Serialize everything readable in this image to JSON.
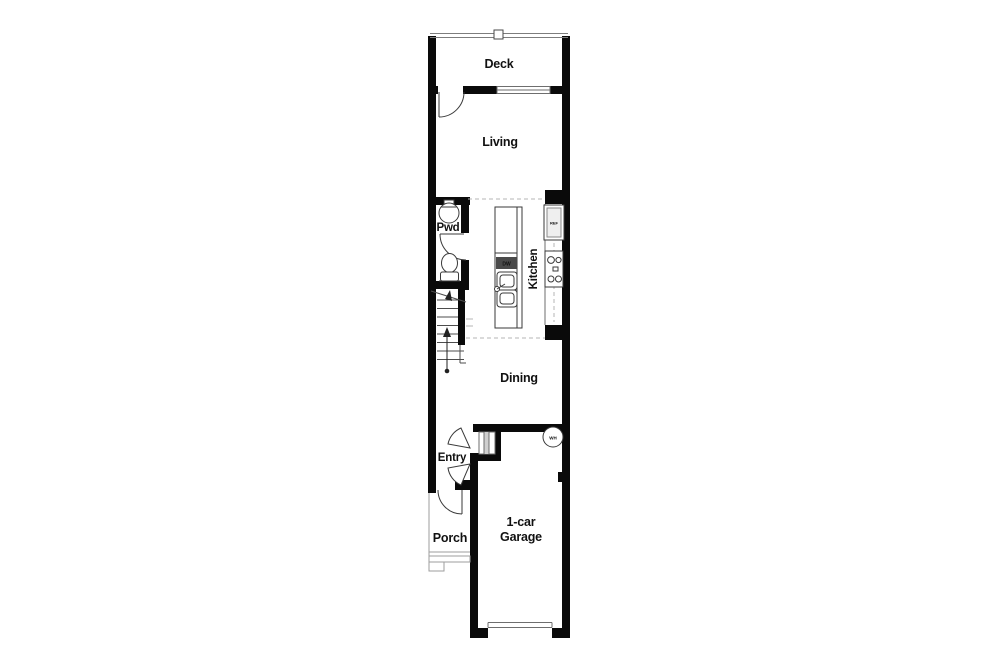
{
  "floor_plan": {
    "labels": {
      "deck": "Deck",
      "living": "Living",
      "pwd": "Pwd",
      "kitchen": "Kitchen",
      "dining": "Dining",
      "entry": "Entry",
      "porch": "Porch",
      "garage_line1": "1-car",
      "garage_line2": "Garage",
      "dishwasher": "DW",
      "refrigerator": "REF",
      "water_heater": "WH"
    },
    "rooms": [
      "Deck",
      "Living",
      "Pwd",
      "Kitchen",
      "Dining",
      "Entry",
      "Porch",
      "1-car Garage"
    ],
    "fixtures": [
      "deck-railing",
      "window",
      "hinged-doors",
      "pedestal-sink",
      "toilet",
      "stairs-up-arrow",
      "kitchen-island",
      "dishwasher",
      "double-basin-sink",
      "refrigerator",
      "range-4-burner",
      "water-heater",
      "entry-steps",
      "porch-steps",
      "garage-door"
    ],
    "colors": {
      "wall": "#0a0a0a",
      "line": "#3a3a3a",
      "light_line": "#9e9e9e",
      "dashed_line": "#b4b4b4",
      "background": "#ffffff",
      "text": "#111111"
    }
  }
}
